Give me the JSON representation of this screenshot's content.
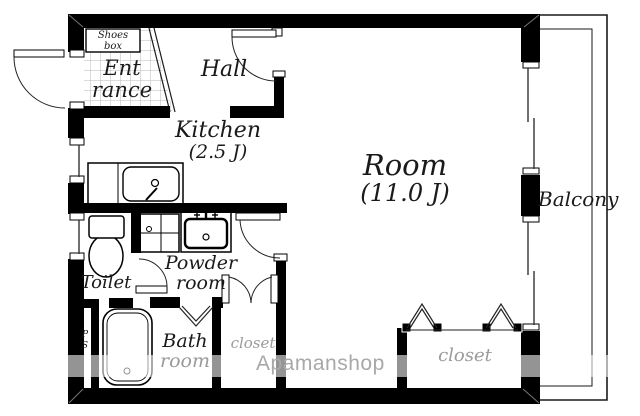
{
  "floorplan": {
    "rooms": {
      "shoes_box": {
        "line1": "Shoes",
        "line2": "box"
      },
      "entrance": {
        "line1": "Ent",
        "line2": "rance"
      },
      "hall": {
        "label": "Hall"
      },
      "kitchen": {
        "label": "Kitchen",
        "size": "(2.5 J)"
      },
      "room": {
        "label": "Room",
        "size": "(11.0 J)"
      },
      "balcony": {
        "label": "Balcony"
      },
      "toilet": {
        "label": "Toilet"
      },
      "powder_room": {
        "line1": "Powder",
        "line2": "room"
      },
      "bath_room": {
        "line1": "Bath",
        "line2": "room"
      },
      "closet_small": {
        "label": "closet"
      },
      "closet_main": {
        "label": "closet"
      },
      "pipe_space": {
        "line1": "P",
        "line2": "S"
      }
    },
    "watermark": {
      "text": "Apamanshop"
    },
    "colors": {
      "wall": "#000000",
      "gray_label": "#9a9a9a",
      "watermark_text": "#a8a8a8",
      "grid_line": "#b8b8b8"
    }
  }
}
